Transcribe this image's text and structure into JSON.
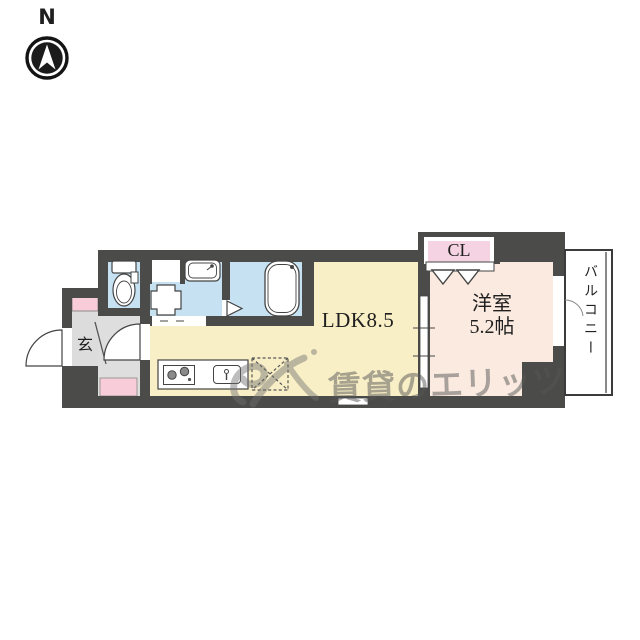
{
  "compass": {
    "north_label": "N"
  },
  "plan": {
    "rooms": {
      "ldk": {
        "label": "LDK8.5"
      },
      "western_room": {
        "label_line1": "洋室",
        "label_line2": "5.2帖"
      },
      "closet": {
        "label": "CL"
      },
      "entrance": {
        "label": "玄"
      },
      "balcony": {
        "label": "バルコニー"
      }
    },
    "fixtures": [
      "toilet",
      "wash-basin",
      "washing-machine-pan",
      "storage-space",
      "bathtub",
      "kitchen-stove",
      "kitchen-sink",
      "refrigerator-space",
      "shoe-cabinet",
      "entrance-door",
      "hall-door",
      "bath-door",
      "closet-folding-door",
      "sliding-door",
      "balcony-door",
      "window"
    ],
    "colors": {
      "wall": "#4b4b49",
      "ldk_floor": "#f9efc6",
      "western_room_floor": "#faeadf",
      "closet_fill": "#f5d3e2",
      "wet_area_floor": "#c5e1f2",
      "entrance_floor": "#dcdcdc",
      "accent_pink": "#f8cdd9"
    }
  },
  "watermark": {
    "text": "賃貸のエリッツ"
  }
}
